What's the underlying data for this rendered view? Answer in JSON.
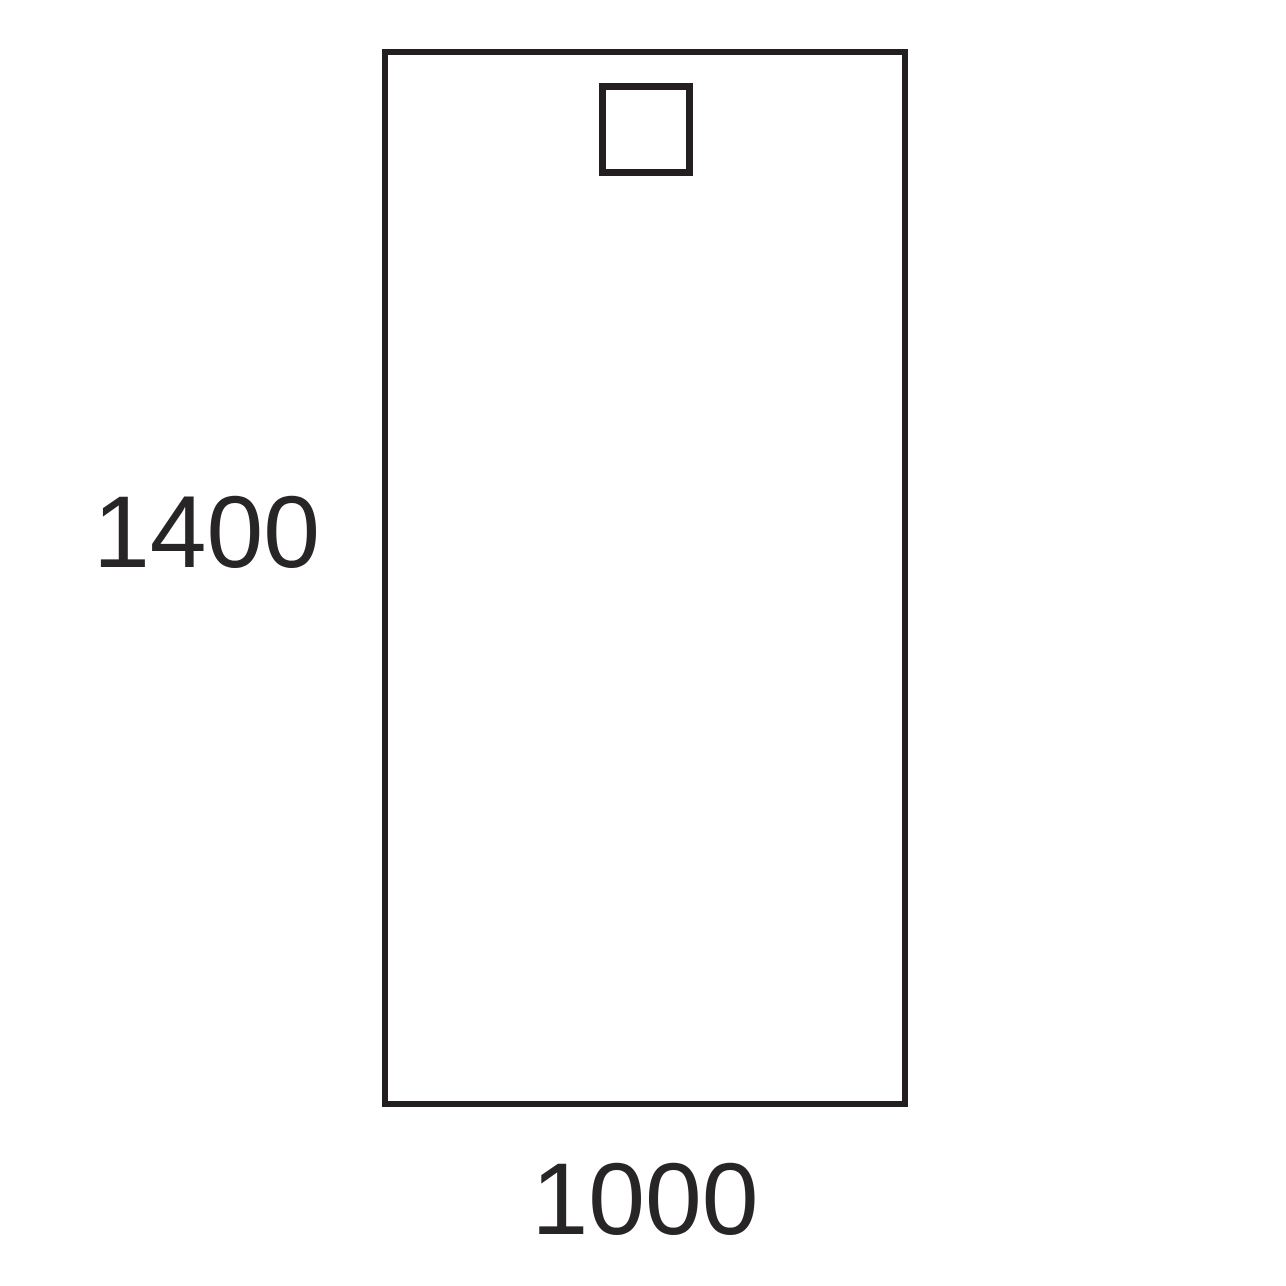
{
  "diagram": {
    "height_label": "1400",
    "width_label": "1000"
  },
  "colors": {
    "background": "#ffffff",
    "stroke": "#231f20",
    "text": "#282526"
  }
}
